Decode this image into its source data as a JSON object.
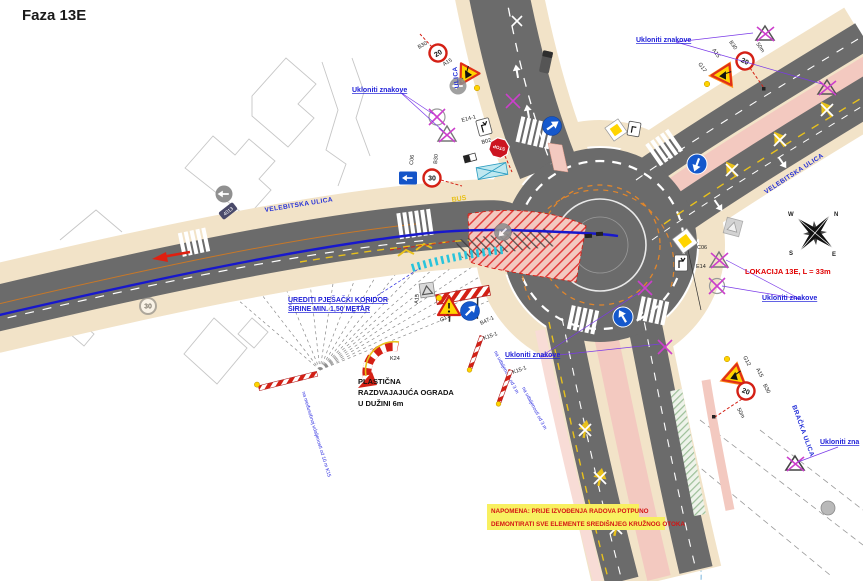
{
  "title": "Faza 13E",
  "streets": {
    "west": "VELEBITSKA ULICA",
    "northeast": "VELEBITSKA ULICA",
    "north": "ULICA",
    "southeast": "BRAČKA ULICA"
  },
  "annotations": {
    "remove_signs": "Ukloniti znakove",
    "remove_signs_short": "Ukloniti zna",
    "corridor_1": "UREDITI PJEŠAČKI KORIDOR",
    "corridor_2": "ŠIRINE MIN. 1,50 METAR",
    "fence_1": "PLASTIČNA",
    "fence_2": "RAZDVAJAJUĆA OGRADA",
    "fence_3": "U DUŽINI 6m",
    "location": "LOKACIJA 13E, L = 33m",
    "note_1": "NAPOMENA: PRIJE IZVOĐENJA RADOVA POTPUNO",
    "note_2": "DEMONTIRATI SVE ELEMENTE SREDIŠNJEG KRUŽNOG OTOKA",
    "k15_spacing": "na međusobnoj udaljenosti od 10 m K15",
    "k15_1_spacing": "na udaljenosti od 3 m",
    "dist_50m": "50m"
  },
  "signs": {
    "speed_20": "20",
    "speed_30": "30",
    "stop": "STOP",
    "bus": "BUS",
    "g17": "G17",
    "g12": "G12",
    "a15": "A15",
    "b30": "B30",
    "b02": "B02",
    "c06": "C06",
    "e14": "E14",
    "e14_1": "E14-1",
    "b47_1": "B47-1",
    "k15_1": "K15-1",
    "k24": "K24",
    "pole_id": "4013"
  },
  "compass": {
    "n": "N",
    "s": "S",
    "e": "E",
    "w": "W"
  },
  "colors": {
    "asphalt": "#6b6b6b",
    "sidewalk": "#f2e3c8",
    "work_pink": "#f3c9c0",
    "cyan_corridor": "#28c4dc",
    "route_blue": "#1818cc",
    "removal_magenta": "#cc3fcc",
    "temp_orange": "#e0862c",
    "marking_yellow": "#e8c11c",
    "alert_red": "#d42015",
    "note_yellow": "#f8f060"
  }
}
